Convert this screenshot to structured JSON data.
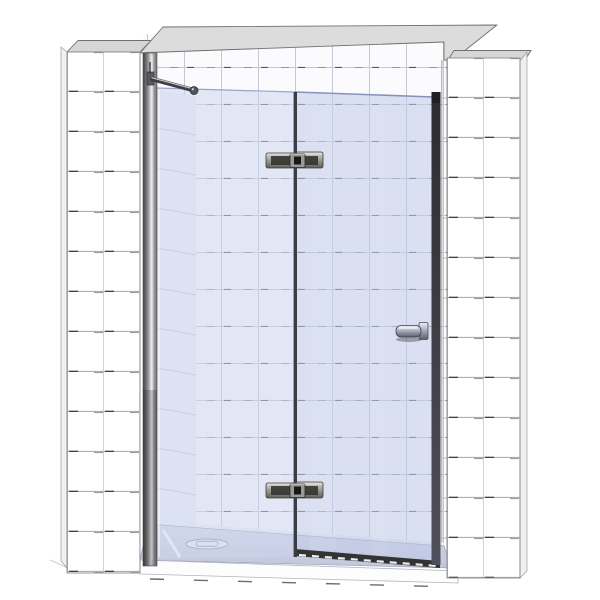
{
  "scene": {
    "kind": "3d-product-render",
    "subject": "frameless-hinged-glass-shower-door-in-tiled-alcove",
    "view": "front-slightly-above-perspective"
  },
  "colors": {
    "background": "#ffffff",
    "wall_top_band": "#dcdcdc",
    "pillar_top_face": "#d6d6d6",
    "tile_white": "#ffffff",
    "grout_light": "#aab0b6",
    "grout_back": "#c4c8d4",
    "grout_dark_dash": "#43464e",
    "glass_fixed": "#ccd3ee",
    "glass_door": "#bfc8e8",
    "glass_edge_line": "#8891b8",
    "hinge_gap": "#3a3d45",
    "door_edge_dark": "#36363c",
    "seal_dark": "#333333",
    "seal_dash_white": "#eeeeee",
    "metal_bright": "#e9e9e4",
    "metal_mid": "#9a9a92",
    "metal_dark": "#55565c",
    "tray_surface": "#c9cee2",
    "tray_step": "#fdfdfd",
    "outline_gray": "#707070"
  },
  "components": {
    "left_wall": "left tiled pillar wall",
    "right_wall": "right tiled pillar wall",
    "back_wall": "tiled back wall of alcove",
    "top_band": "top edge of alcove walls",
    "wall_profile": "aluminium wall mounting profile",
    "support_bar": "glass support stabilizer bar",
    "fixed_panel": "fixed inline glass panel",
    "door_panel": "hinged glass door panel",
    "top_hinge": "glass-to-glass hinge (top)",
    "bottom_hinge": "glass-to-glass hinge (bottom)",
    "handle": "door knob handle",
    "side_seal": "door closing side seal strip",
    "bottom_seal": "door bottom drip seal",
    "tray": "low-profile shower tray",
    "drain": "tray waste drain cover",
    "step": "tray front step edge"
  }
}
